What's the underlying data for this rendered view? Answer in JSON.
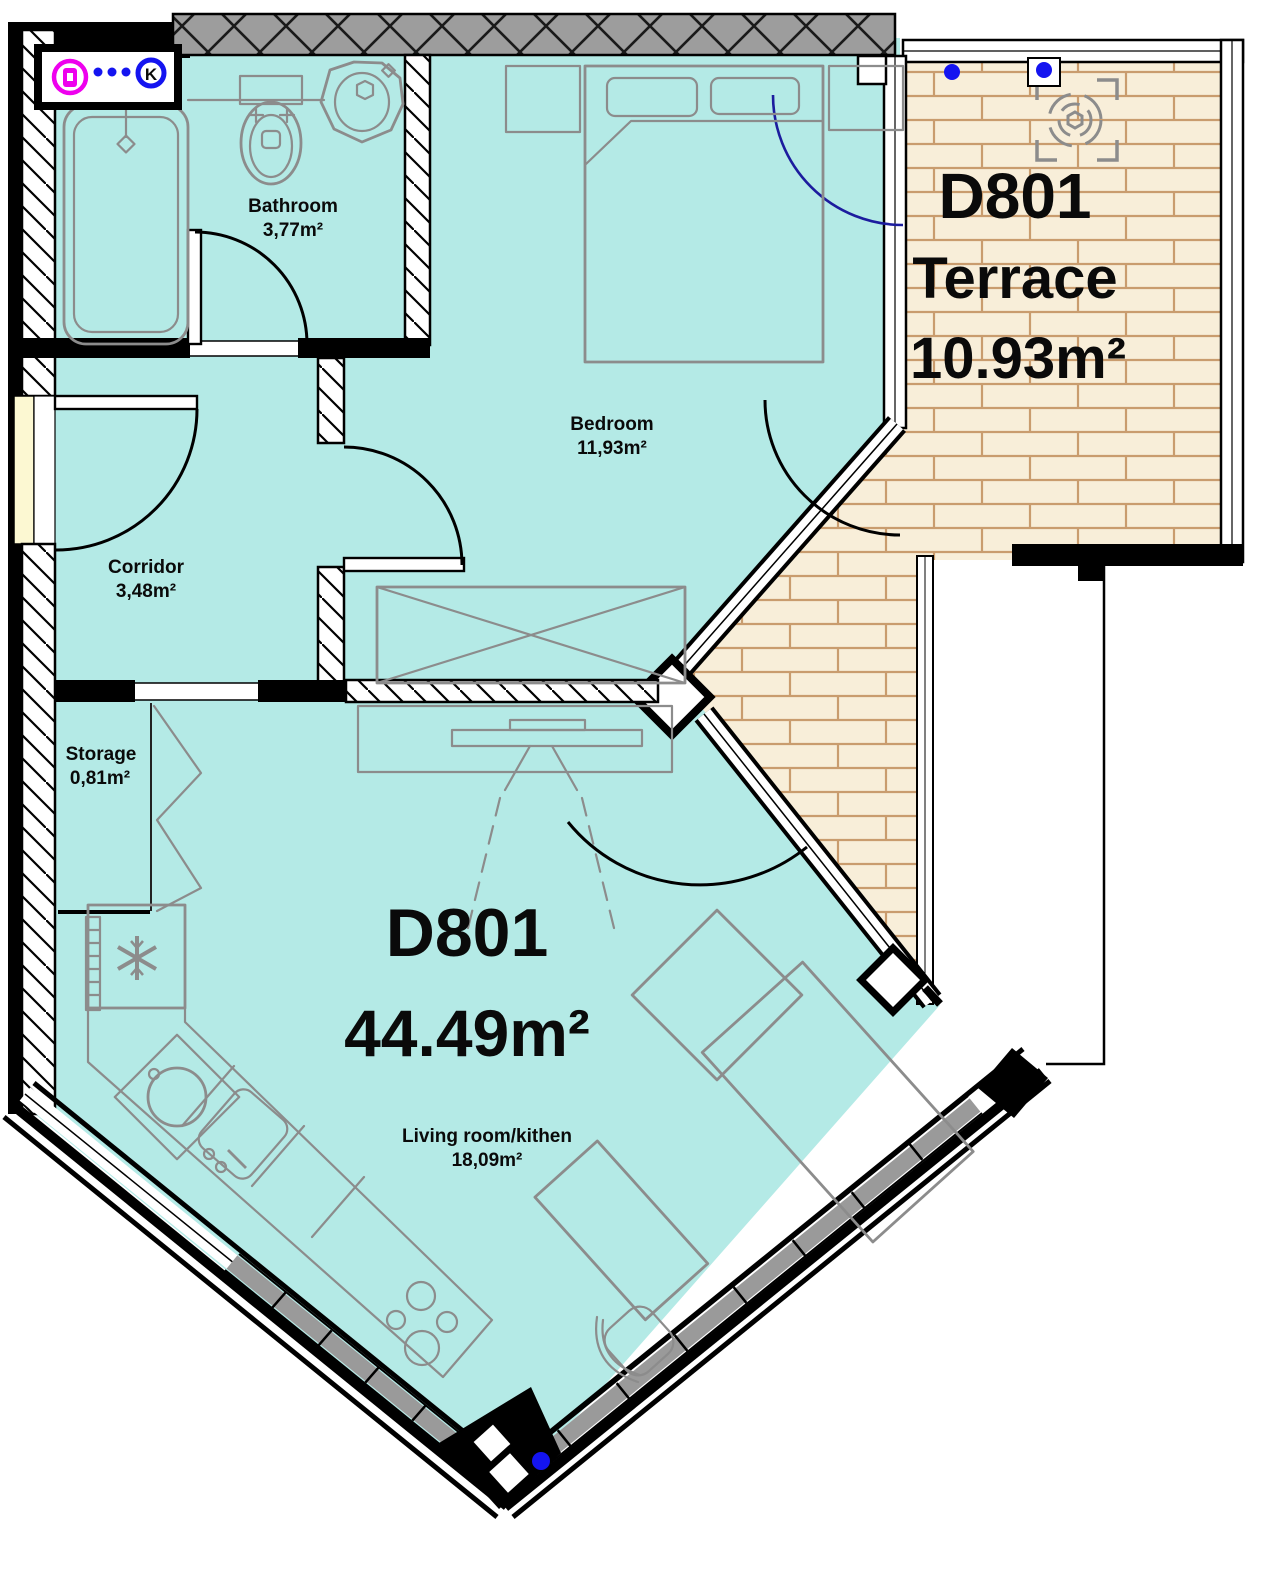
{
  "unit": {
    "id": "D801",
    "area": "44.49m²"
  },
  "terrace": {
    "id": "D801",
    "name": "Terrace",
    "area": "10.93m²"
  },
  "rooms": [
    {
      "id": "bathroom",
      "name": "Bathroom",
      "area": "3,77m²"
    },
    {
      "id": "bedroom",
      "name": "Bedroom",
      "area": "11,93m²"
    },
    {
      "id": "corridor",
      "name": "Corridor",
      "area": "3,48m²"
    },
    {
      "id": "storage",
      "name": "Storage",
      "area": "0,81m²"
    },
    {
      "id": "living",
      "name": "Living room/kithen",
      "area": "18,09m²"
    }
  ],
  "markers": {
    "k_label": "K"
  },
  "colors": {
    "floor": "#b4eae6",
    "terrace_floor": "#f8eed9",
    "brick_line": "#c99c6e",
    "wall": "#000000",
    "top_wall": "#9d9d9d",
    "railing": "#9a9a9a",
    "furniture": "#8c8c8c",
    "threshold": "#fcf8d2",
    "door_swing_blue": "#1c1c9e",
    "marker_blue": "#1414f0",
    "marker_magenta": "#ee00ee"
  }
}
